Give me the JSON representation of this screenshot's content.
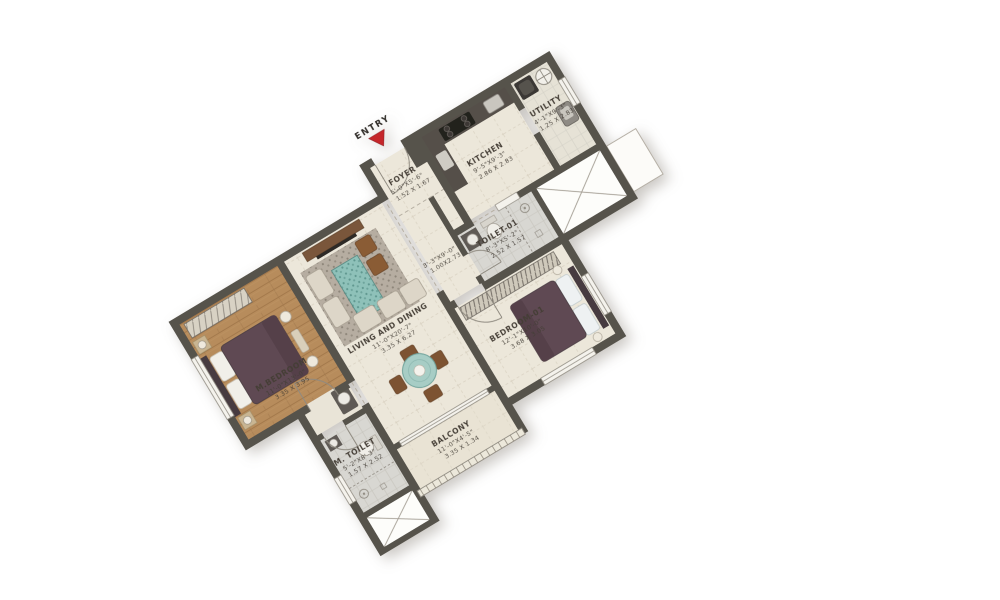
{
  "entry": {
    "label": "ENTRY"
  },
  "rooms": {
    "m_bedroom": {
      "name": "M.BEDROOM",
      "dim_ft": "11'-0\"X13'-0\"",
      "dim_m": "3.35 X 3.95"
    },
    "living_dining": {
      "name": "LIVING AND DINING",
      "dim_ft": "11'-0\"X20'-7\"",
      "dim_m": "3.35 X 6.27"
    },
    "foyer": {
      "name": "FOYER",
      "dim_ft": "5'-0\"X5'-6\"",
      "dim_m": "1.52 X 1.67"
    },
    "kitchen": {
      "name": "KITCHEN",
      "dim_ft": "9'-5\"X9'-3\"",
      "dim_m": "2.86 X 2.83"
    },
    "utility": {
      "name": "UTILITY",
      "dim_ft": "4'-1\"X9'-3\"",
      "dim_m": "1.25 X 2.83"
    },
    "passage": {
      "dim_ft": "3'-3\"X9'-0\"",
      "dim_m": "1.00X2.73"
    },
    "toilet_01": {
      "name": "TOILET-01",
      "dim_ft": "8'-3\"X5'-2\"",
      "dim_m": "2.52 X 1.57"
    },
    "bedroom_01": {
      "name": "BEDROOM-01",
      "dim_ft": "12'-1\"X10'-0\"",
      "dim_m": "3.68 X 3.05"
    },
    "m_toilet": {
      "name": "M. TOILET",
      "dim_ft": "5'-2\"X8'-3\"",
      "dim_m": "1.57 X 2.52"
    },
    "balcony": {
      "name": "BALCONY",
      "dim_ft": "11'-0\"X4'-5\"",
      "dim_m": "3.35 X 1.34"
    }
  },
  "colors": {
    "wall": "#57524b",
    "floor_cream": "#ece7da",
    "floor_wood": "#b78c5c",
    "floor_tile": "#d8d7d2",
    "bed": "#5e4a52",
    "rug_teal": "#8ec1b9",
    "entry_arrow_red": "#c5262c"
  }
}
